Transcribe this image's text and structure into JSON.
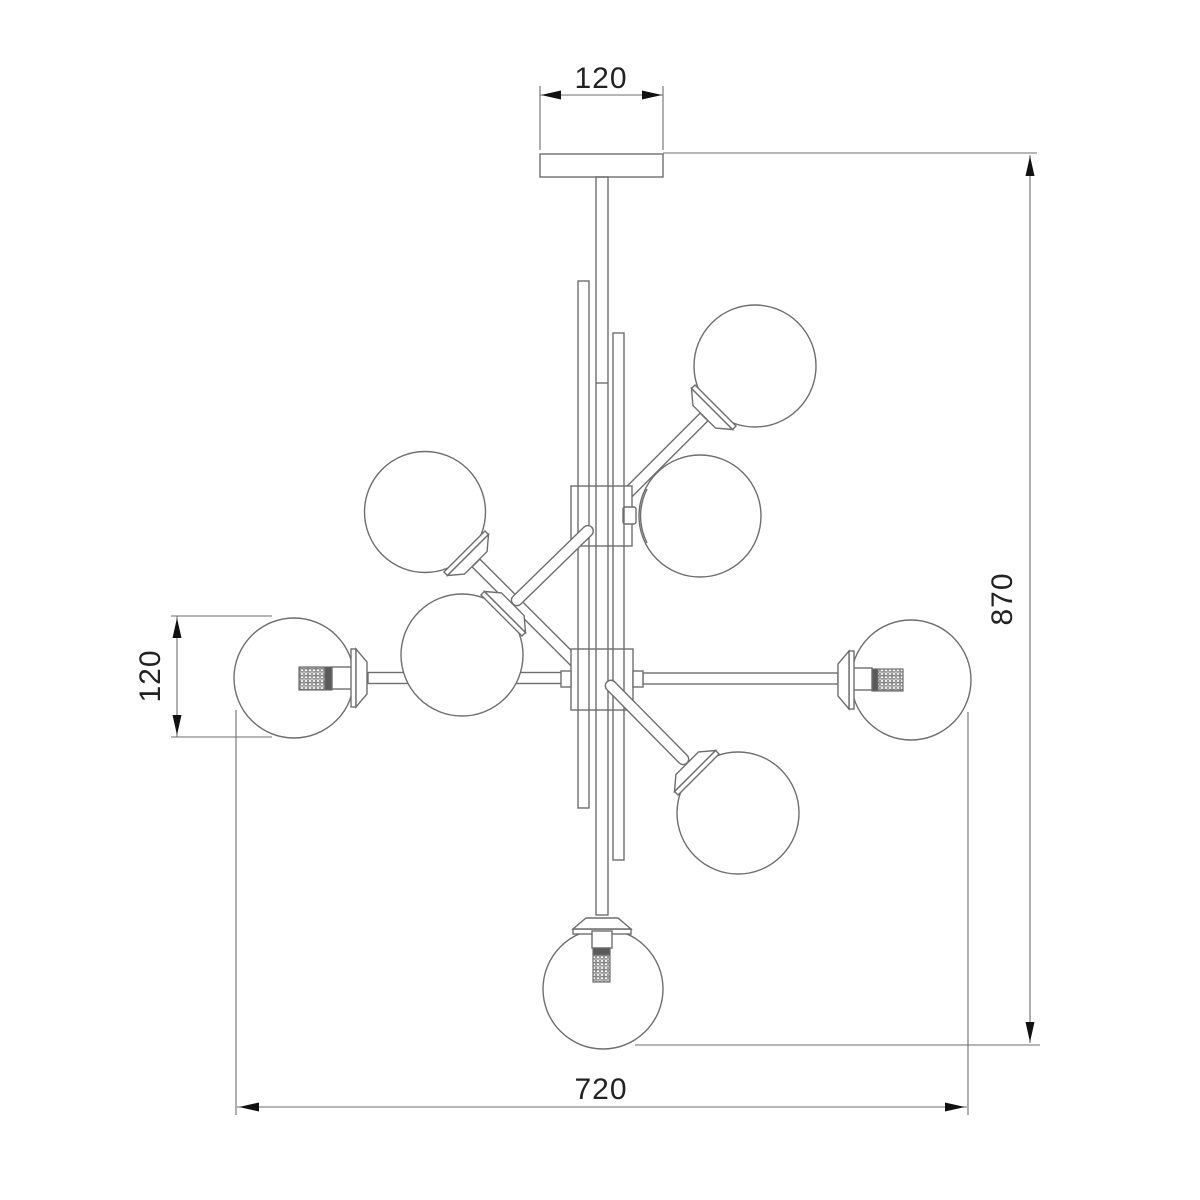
{
  "drawing": {
    "title": "chandelier-dimension-drawing",
    "globe_count": 8,
    "colors": {
      "line": "#6e6e6e",
      "arrow": "#111111",
      "text": "#222222",
      "background": "#ffffff"
    }
  },
  "dimensions": {
    "canopy_width": "120",
    "total_height": "870",
    "shade_diameter": "120",
    "total_width": "720"
  }
}
